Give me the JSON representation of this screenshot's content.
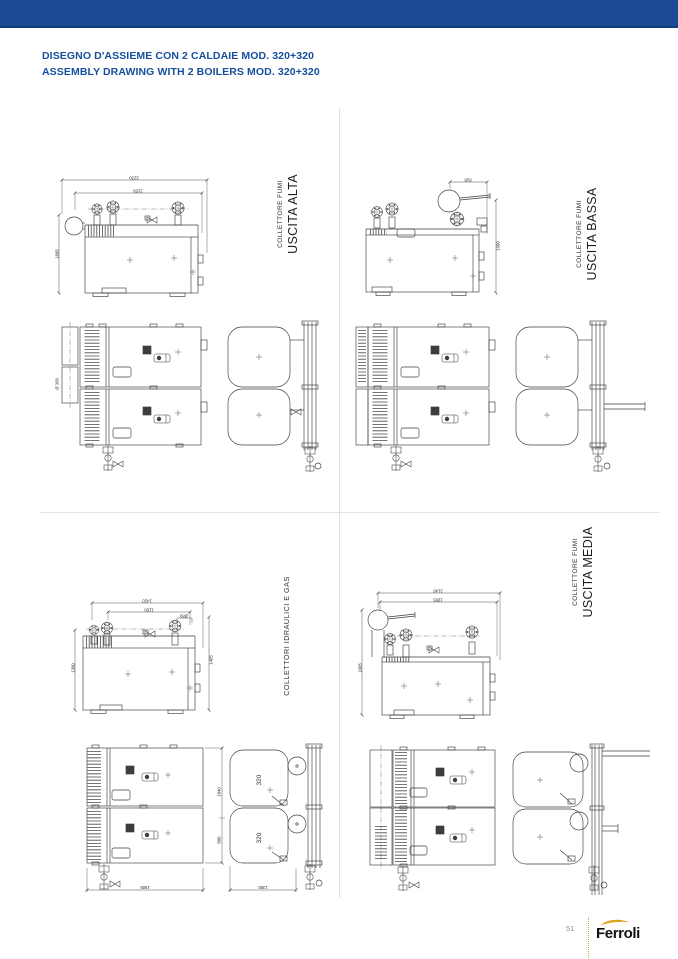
{
  "header": {
    "title_it": "DISEGNO D'ASSIEME CON 2 CALDAIE MOD. 320+320",
    "title_en": "ASSEMBLY DRAWING WITH 2 BOILERS MOD. 320+320"
  },
  "quadrants": {
    "top_left": {
      "label_small": "COLLETTORE FUMI",
      "label_big": "USCITA ALTA",
      "dims": {
        "total_width": "2230",
        "inner_width": "2159",
        "height": "1685",
        "flue_diameter": "Ø 350"
      }
    },
    "top_right": {
      "label_small": "COLLETTORE FUMI",
      "label_big": "USCITA BASSA",
      "dims": {
        "flue_offset": "828",
        "height": "1900"
      }
    },
    "bottom_left": {
      "label_single": "COLLETTORI IDRAULICI E GAS",
      "dims": {
        "side_width": "1420",
        "side_inner": "1150",
        "side_stub": "Ø80",
        "side_height_left": "1360",
        "side_height_right": "1405"
      },
      "plan": {
        "width_left": "1985",
        "width_right": "1380",
        "depth_total": "1840",
        "depth_inner": "800",
        "model": "320"
      }
    },
    "bottom_right": {
      "label_small": "COLLETTORE FUMI",
      "label_big": "USCITA MEDIA",
      "dims": {
        "total_width": "2146",
        "inner_width": "1955",
        "height": "1905"
      }
    }
  },
  "footer": {
    "page_number": "51",
    "brand": "Ferroli"
  },
  "colors": {
    "top_bar": "#1b4b93",
    "title_blue": "#164f9c",
    "divider": "#e0e0e0",
    "drawing_line": "#3d3d3d",
    "gold_accent": "#dfa01e",
    "page_number_gray": "#8f8f8f"
  }
}
